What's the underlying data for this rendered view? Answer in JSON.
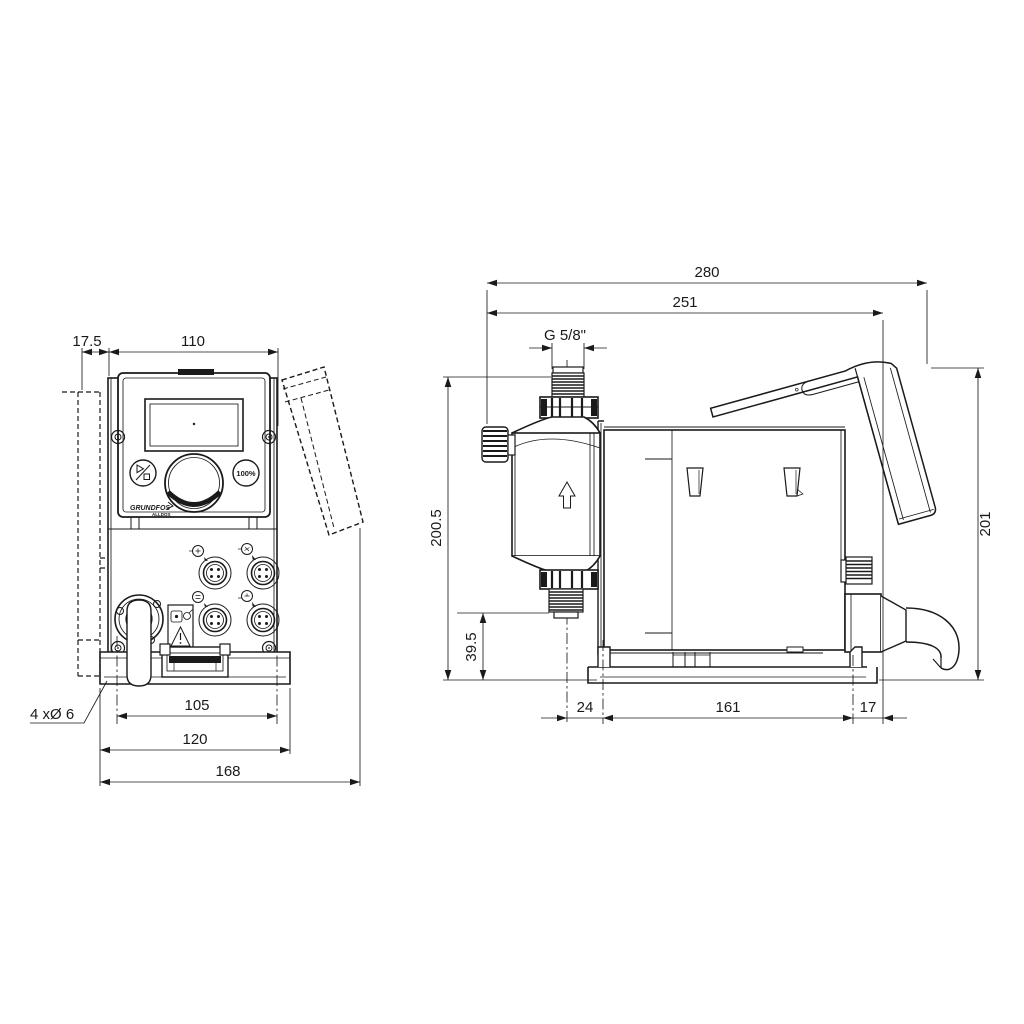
{
  "drawing": {
    "background": "#ffffff",
    "line_color": "#1a1a1a",
    "front_view": {
      "dims": {
        "wall_offset": "17.5",
        "housing_width": "110",
        "hole_spacing": "105",
        "base_width": "120",
        "overall_width": "168",
        "mounting_holes": "4 xØ 6"
      },
      "panel": {
        "run_button": "100%",
        "logo": "GRUNDFOS",
        "logo_sub": "ALLDOS"
      }
    },
    "side_view": {
      "dims": {
        "overall_depth": "280",
        "depth_to_mounting_face": "251",
        "connection_thread": "G 5/8\"",
        "height_to_discharge": "200.5",
        "suction_valve_height": "39.5",
        "overall_height": "201",
        "front_overhang": "24",
        "hole_spacing": "161",
        "rear_overhang": "17"
      }
    }
  }
}
